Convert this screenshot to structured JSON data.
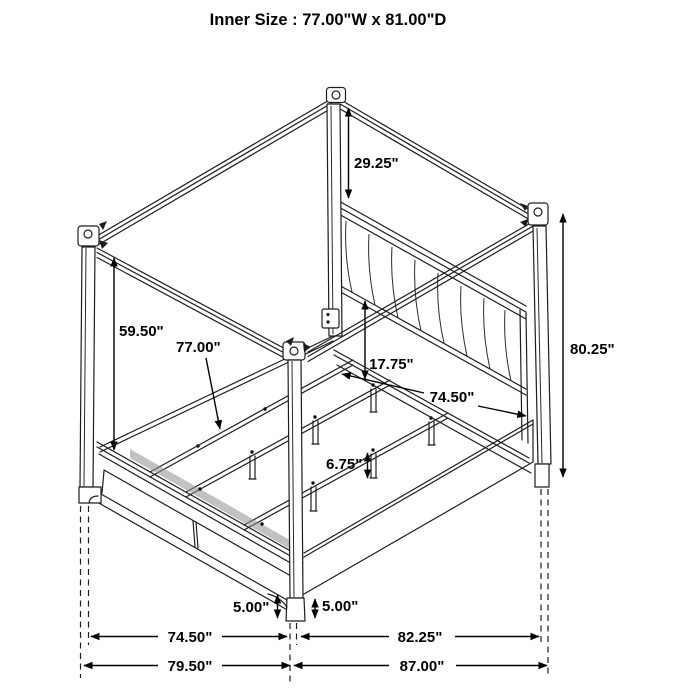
{
  "title": "Inner Size : 77.00\"W x 81.00\"D",
  "dimensions": {
    "post_above_headboard": "29.25\"",
    "floor_to_canopy": "59.50\"",
    "inner_width": "77.00\"",
    "rail_to_headboard_bottom": "17.75\"",
    "width_between_posts": "74.50\"",
    "overall_height": "80.25\"",
    "slat_leg_height": "6.75\"",
    "footboard_clearance": "5.00\"",
    "siderail_clearance": "5.00\"",
    "front_inner_span": "74.50\"",
    "front_outer_span": "79.50\"",
    "side_inner_span": "82.25\"",
    "side_outer_span": "87.00\""
  }
}
